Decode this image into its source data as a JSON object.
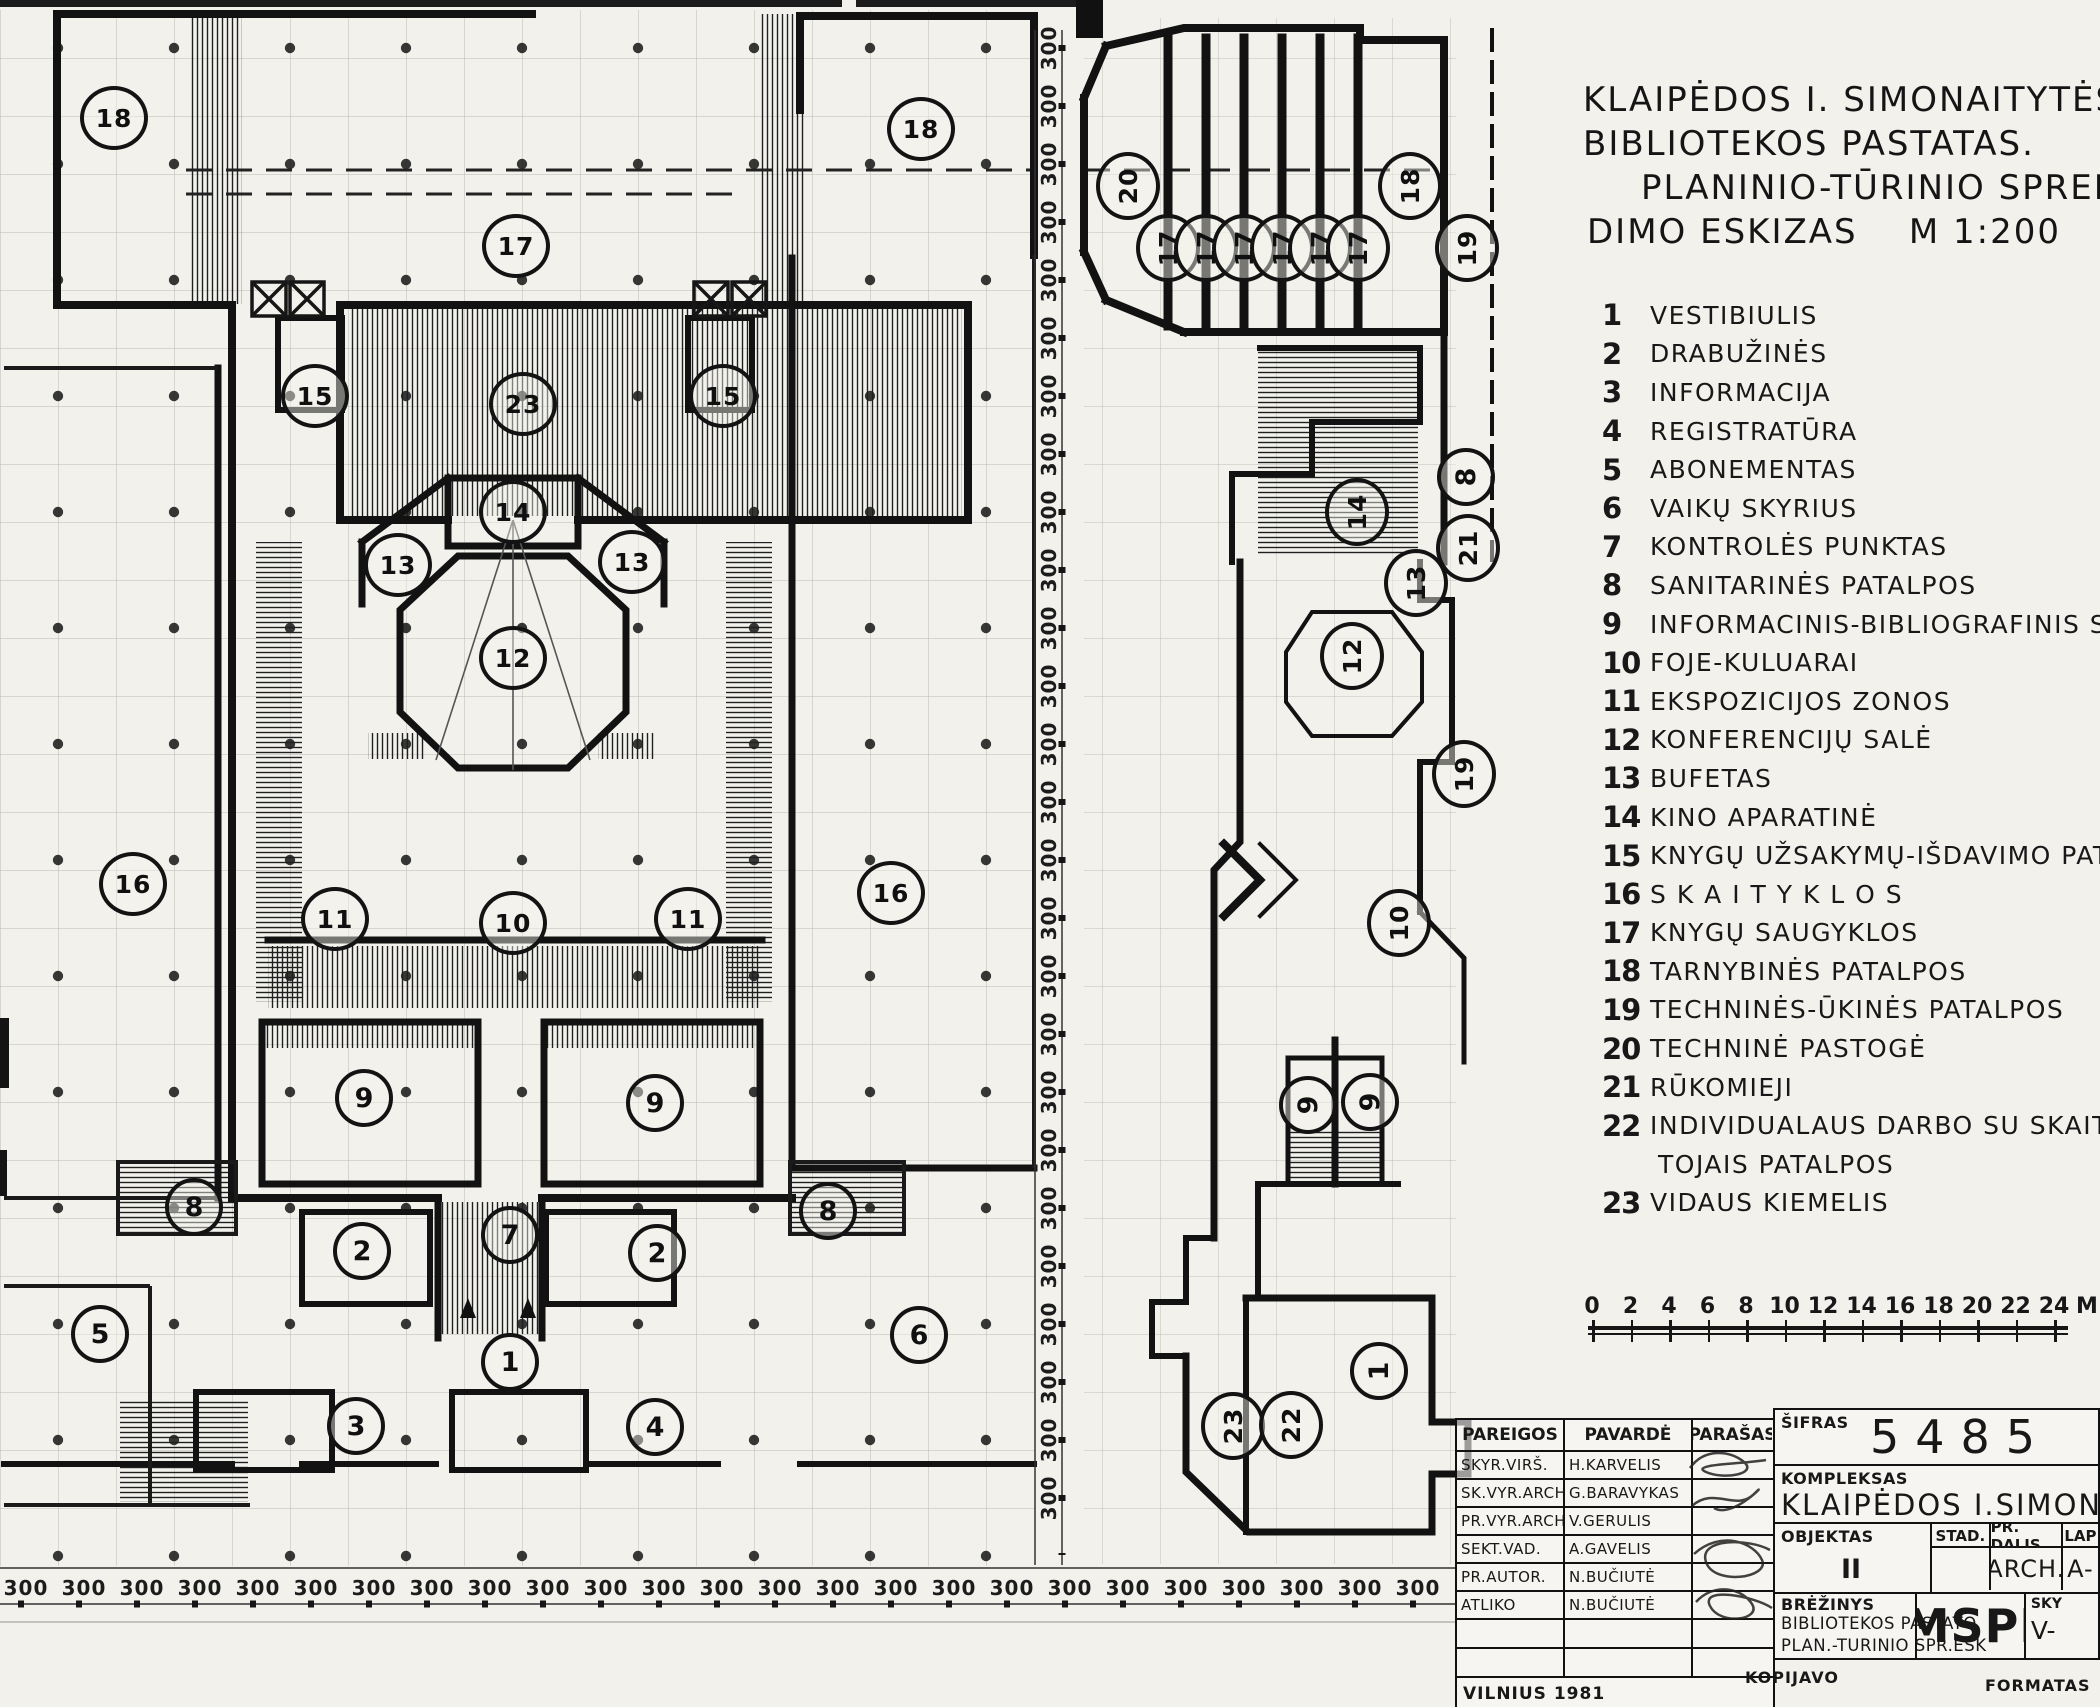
{
  "title": {
    "lines": [
      "KLAIPĖDOS I. SIMONAITYTĖS",
      "BIBLIOTEKOS PASTATAS.",
      "PLANINIO-TŪRINIO SPREN",
      "DIMO ESKIZAS    M 1:200"
    ]
  },
  "legend": {
    "items": [
      {
        "num": "1",
        "label": "VESTIBIULIS"
      },
      {
        "num": "2",
        "label": "DRABUŽINĖS"
      },
      {
        "num": "3",
        "label": "INFORMACIJA"
      },
      {
        "num": "4",
        "label": "REGISTRATŪRA"
      },
      {
        "num": "5",
        "label": "ABONEMENTAS"
      },
      {
        "num": "6",
        "label": "VAIKŲ SKYRIUS"
      },
      {
        "num": "7",
        "label": "KONTROLĖS PUNKTAS"
      },
      {
        "num": "8",
        "label": "SANITARINĖS PATALPOS"
      },
      {
        "num": "9",
        "label": "INFORMACINIS-BIBLIOGRAFINIS SKYR"
      },
      {
        "num": "10",
        "label": "FOJE-KULUARAI"
      },
      {
        "num": "11",
        "label": "EKSPOZICIJOS ZONOS"
      },
      {
        "num": "12",
        "label": "KONFERENCIJŲ SALĖ"
      },
      {
        "num": "13",
        "label": "BUFETAS"
      },
      {
        "num": "14",
        "label": "KINO APARATINĖ"
      },
      {
        "num": "15",
        "label": "KNYGŲ UŽSAKYMŲ-IŠDAVIMO PAT."
      },
      {
        "num": "16",
        "label": "S K A I T Y K L O S"
      },
      {
        "num": "17",
        "label": "KNYGŲ SAUGYKLOS"
      },
      {
        "num": "18",
        "label": "TARNYBINĖS PATALPOS"
      },
      {
        "num": "19",
        "label": "TECHNINĖS-ŪKINĖS PATALPOS"
      },
      {
        "num": "20",
        "label": "TECHNINĖ PASTOGĖ"
      },
      {
        "num": "21",
        "label": "RŪKOMIEJI"
      },
      {
        "num": "22",
        "label": "INDIVIDUALAUS DARBO SU SKAITY-",
        "label2": "TOJAIS PATALPOS"
      },
      {
        "num": "23",
        "label": "VIDAUS KIEMELIS"
      }
    ]
  },
  "scale_bar": {
    "ticks": [
      "0",
      "2",
      "4",
      "6",
      "8",
      "10",
      "12",
      "14",
      "16",
      "18",
      "20",
      "22",
      "24"
    ],
    "unit": "M"
  },
  "plan": {
    "dim_text": "300",
    "v_dims": {
      "count": 26
    },
    "h_dims": {
      "count": 25
    },
    "circles": [
      {
        "n": "18",
        "x": 114,
        "y": 118
      },
      {
        "n": "17",
        "x": 516,
        "y": 246
      },
      {
        "n": "18",
        "x": 921,
        "y": 129
      },
      {
        "n": "15",
        "x": 315,
        "y": 396
      },
      {
        "n": "23",
        "x": 523,
        "y": 404
      },
      {
        "n": "15",
        "x": 723,
        "y": 396
      },
      {
        "n": "14",
        "x": 513,
        "y": 512
      },
      {
        "n": "13",
        "x": 398,
        "y": 565
      },
      {
        "n": "13",
        "x": 632,
        "y": 562
      },
      {
        "n": "12",
        "x": 513,
        "y": 658
      },
      {
        "n": "16",
        "x": 133,
        "y": 884
      },
      {
        "n": "11",
        "x": 335,
        "y": 919
      },
      {
        "n": "10",
        "x": 513,
        "y": 923
      },
      {
        "n": "11",
        "x": 688,
        "y": 919
      },
      {
        "n": "16",
        "x": 891,
        "y": 893
      },
      {
        "n": "9",
        "x": 364,
        "y": 1098
      },
      {
        "n": "9",
        "x": 655,
        "y": 1103
      },
      {
        "n": "8",
        "x": 194,
        "y": 1207
      },
      {
        "n": "8",
        "x": 828,
        "y": 1211
      },
      {
        "n": "2",
        "x": 362,
        "y": 1251
      },
      {
        "n": "7",
        "x": 510,
        "y": 1235
      },
      {
        "n": "2",
        "x": 657,
        "y": 1253
      },
      {
        "n": "5",
        "x": 100,
        "y": 1334
      },
      {
        "n": "1",
        "x": 510,
        "y": 1362
      },
      {
        "n": "6",
        "x": 919,
        "y": 1335
      },
      {
        "n": "3",
        "x": 356,
        "y": 1426
      },
      {
        "n": "4",
        "x": 655,
        "y": 1427
      },
      {
        "n": "20",
        "x": 1128,
        "y": 186,
        "rot": true
      },
      {
        "n": "17",
        "x": 1168,
        "y": 248,
        "rot": true
      },
      {
        "n": "17",
        "x": 1206,
        "y": 248,
        "rot": true
      },
      {
        "n": "17",
        "x": 1244,
        "y": 248,
        "rot": true
      },
      {
        "n": "17",
        "x": 1282,
        "y": 248,
        "rot": true
      },
      {
        "n": "17",
        "x": 1320,
        "y": 248,
        "rot": true
      },
      {
        "n": "17",
        "x": 1358,
        "y": 248,
        "rot": true
      },
      {
        "n": "18",
        "x": 1410,
        "y": 186,
        "rot": true
      },
      {
        "n": "19",
        "x": 1467,
        "y": 248,
        "rot": true
      },
      {
        "n": "14",
        "x": 1357,
        "y": 512,
        "rot": true
      },
      {
        "n": "8",
        "x": 1466,
        "y": 477,
        "rot": true
      },
      {
        "n": "21",
        "x": 1468,
        "y": 548,
        "rot": true
      },
      {
        "n": "13",
        "x": 1416,
        "y": 583,
        "rot": true
      },
      {
        "n": "12",
        "x": 1352,
        "y": 656,
        "rot": true
      },
      {
        "n": "19",
        "x": 1464,
        "y": 774,
        "rot": true
      },
      {
        "n": "10",
        "x": 1399,
        "y": 923,
        "rot": true
      },
      {
        "n": "9",
        "x": 1308,
        "y": 1105,
        "rot": true
      },
      {
        "n": "9",
        "x": 1370,
        "y": 1102,
        "rot": true
      },
      {
        "n": "1",
        "x": 1379,
        "y": 1371,
        "rot": true
      },
      {
        "n": "23",
        "x": 1233,
        "y": 1426,
        "rot": true
      },
      {
        "n": "22",
        "x": 1291,
        "y": 1425,
        "rot": true
      }
    ]
  },
  "titleblock": {
    "headers": {
      "pareigos": "PAREIGOS",
      "pavarde": "PAVARDĖ",
      "parasas": "PARAŠAS",
      "sifras": "ŠIFRAS"
    },
    "sifras_value": "5485",
    "rows": [
      {
        "role": "SKYR.VIRŠ.",
        "name": "H.KARVELIS"
      },
      {
        "role": "SK.VYR.ARCH",
        "name": "G.BARAVYKAS"
      },
      {
        "role": "PR.VYR.ARCH",
        "name": "V.GERULIS"
      },
      {
        "role": "SEKT.VAD.",
        "name": "A.GAVELIS"
      },
      {
        "role": "PR.AUTOR.",
        "name": "N.BUČIUTĖ"
      },
      {
        "role": "ATLIKO",
        "name": "N.BUČIUTĖ"
      }
    ],
    "kompleksas_label": "KOMPLEKSAS",
    "kompleksas_value": "KLAIPĖDOS I.SIMONAITYTĖS V. BIBLIOTE",
    "objektas_label": "OBJEKTAS",
    "objektas_value": "II",
    "stad_label": "STAD.",
    "pr_dalis_label": "PR. DALIS",
    "pr_dalis_value": "ARCH.",
    "lap_label": "LAP",
    "lap_value": "A-",
    "brezinys_label": "BRĖŽINYS",
    "brezinys_line1": "BIBLIOTEKOS PASTATO",
    "brezinys_line2": "PLAN.-TURINIO SPR.ESK",
    "org": "MSPI",
    "sky_label": "SKY",
    "sky_value": "V-",
    "vilnius": "VILNIUS 1981",
    "kopijavo": "KOPIJAVO",
    "formatas": "FORMATAS"
  }
}
